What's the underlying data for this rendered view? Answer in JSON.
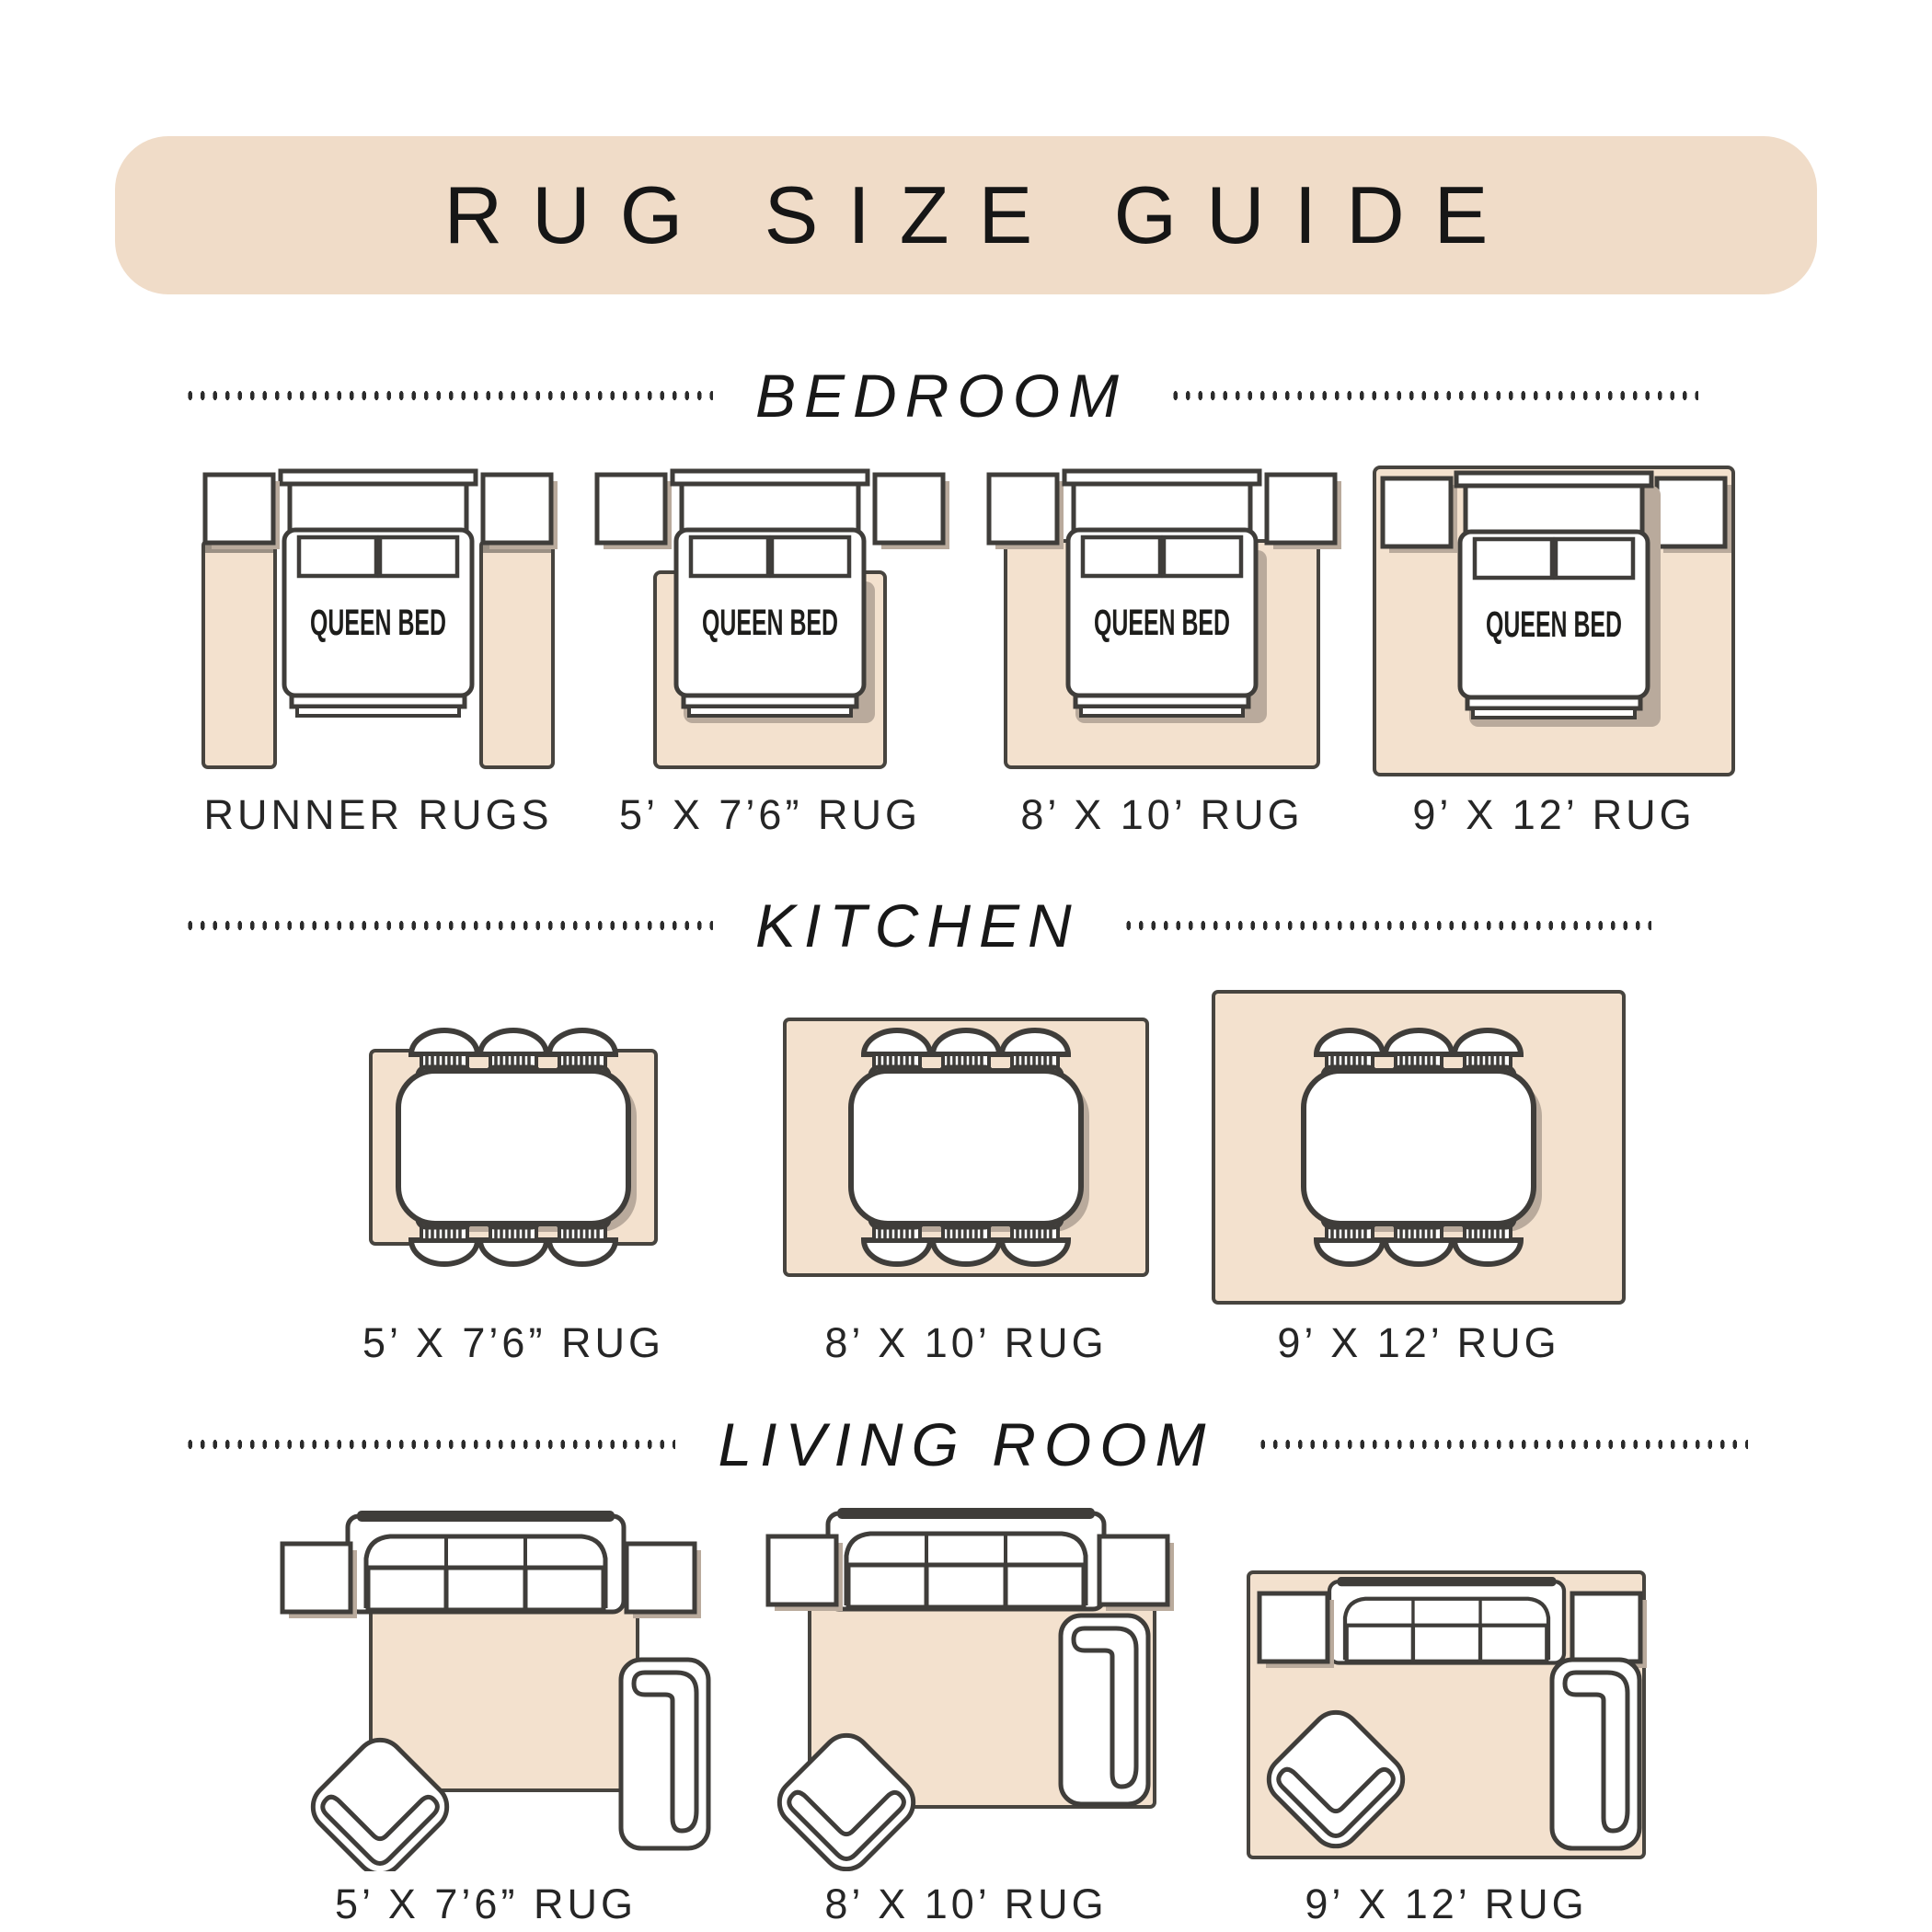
{
  "header": {
    "title": "RUG SIZE GUIDE"
  },
  "bed_label": "QUEEN BED",
  "colors": {
    "band": "#f0dcc8",
    "rug_fill": "#f3e1ce",
    "rug_border": "#47443f",
    "furniture_line": "#3f3d3a",
    "shadow": "#b9aa9c",
    "text": "#262626"
  },
  "sections": [
    {
      "name": "BEDROOM",
      "items": [
        {
          "label": "RUNNER RUGS"
        },
        {
          "label": "5’ X 7’6” RUG"
        },
        {
          "label": "8’ X 10’ RUG"
        },
        {
          "label": "9’ X 12’ RUG"
        }
      ]
    },
    {
      "name": "KITCHEN",
      "items": [
        {
          "label": "5’ X 7’6” RUG"
        },
        {
          "label": "8’ X 10’ RUG"
        },
        {
          "label": "9’ X 12’ RUG"
        }
      ]
    },
    {
      "name": "LIVING ROOM",
      "items": [
        {
          "label": "5’ X 7’6” RUG"
        },
        {
          "label": "8’ X 10’ RUG"
        },
        {
          "label": "9’ X 12’ RUG"
        }
      ]
    }
  ]
}
